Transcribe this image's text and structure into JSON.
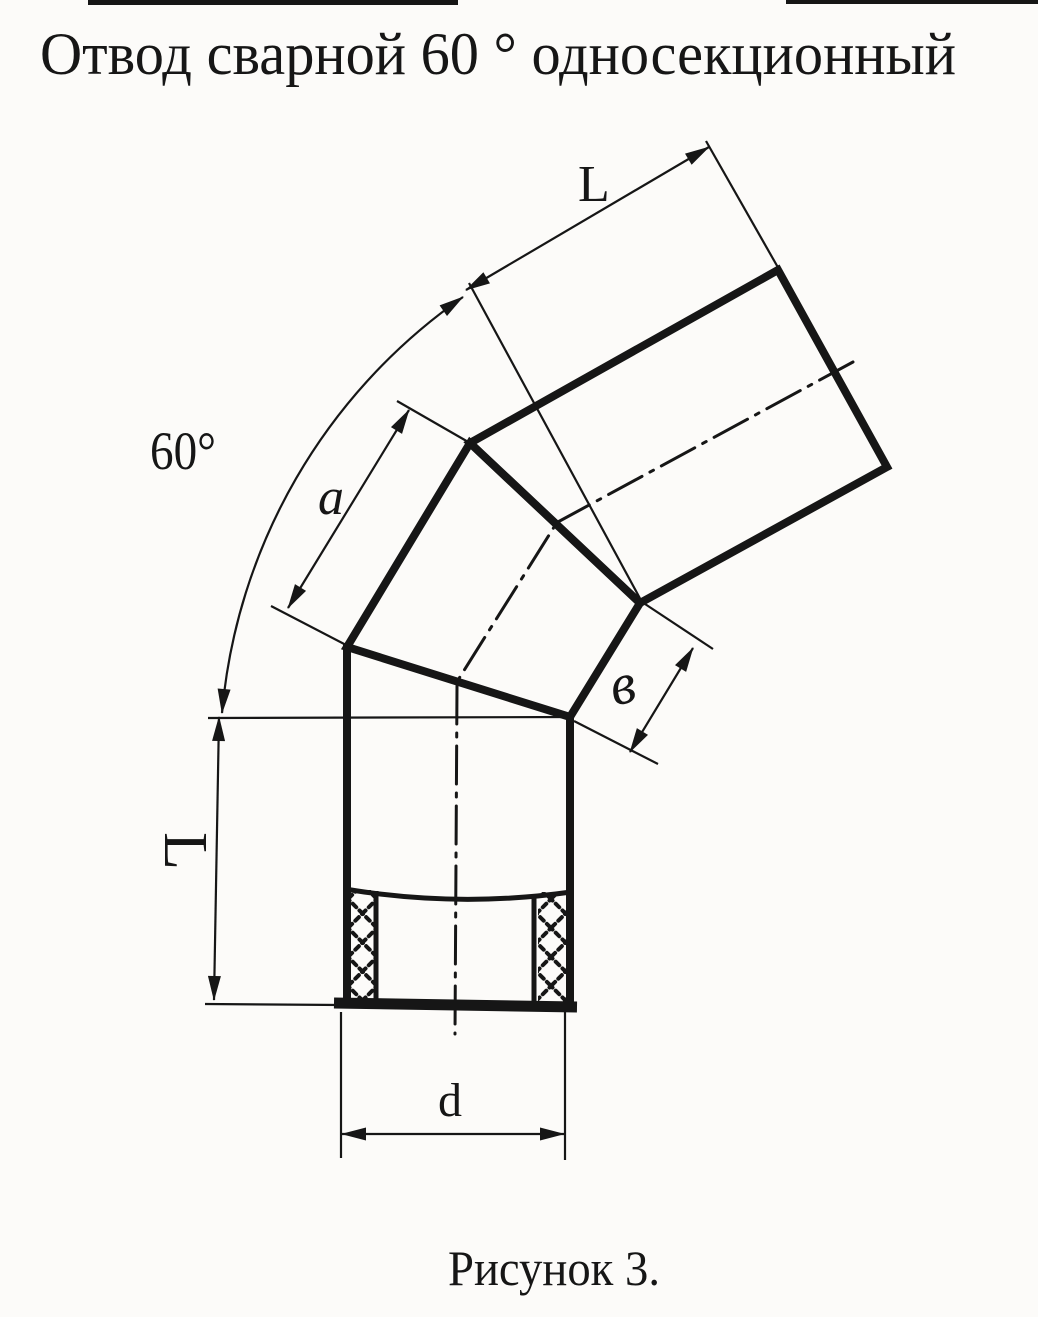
{
  "title": "Отвод сварной 60 ° односекционный",
  "caption": "Рисунок 3.",
  "labels": {
    "upper_length": "L",
    "bend_angle": "60°",
    "section_edge": "a",
    "joint_width": "в",
    "lower_length": "L",
    "diameter": "d"
  },
  "colors": {
    "ink": "#161616",
    "paper": "#fcfbf9"
  }
}
